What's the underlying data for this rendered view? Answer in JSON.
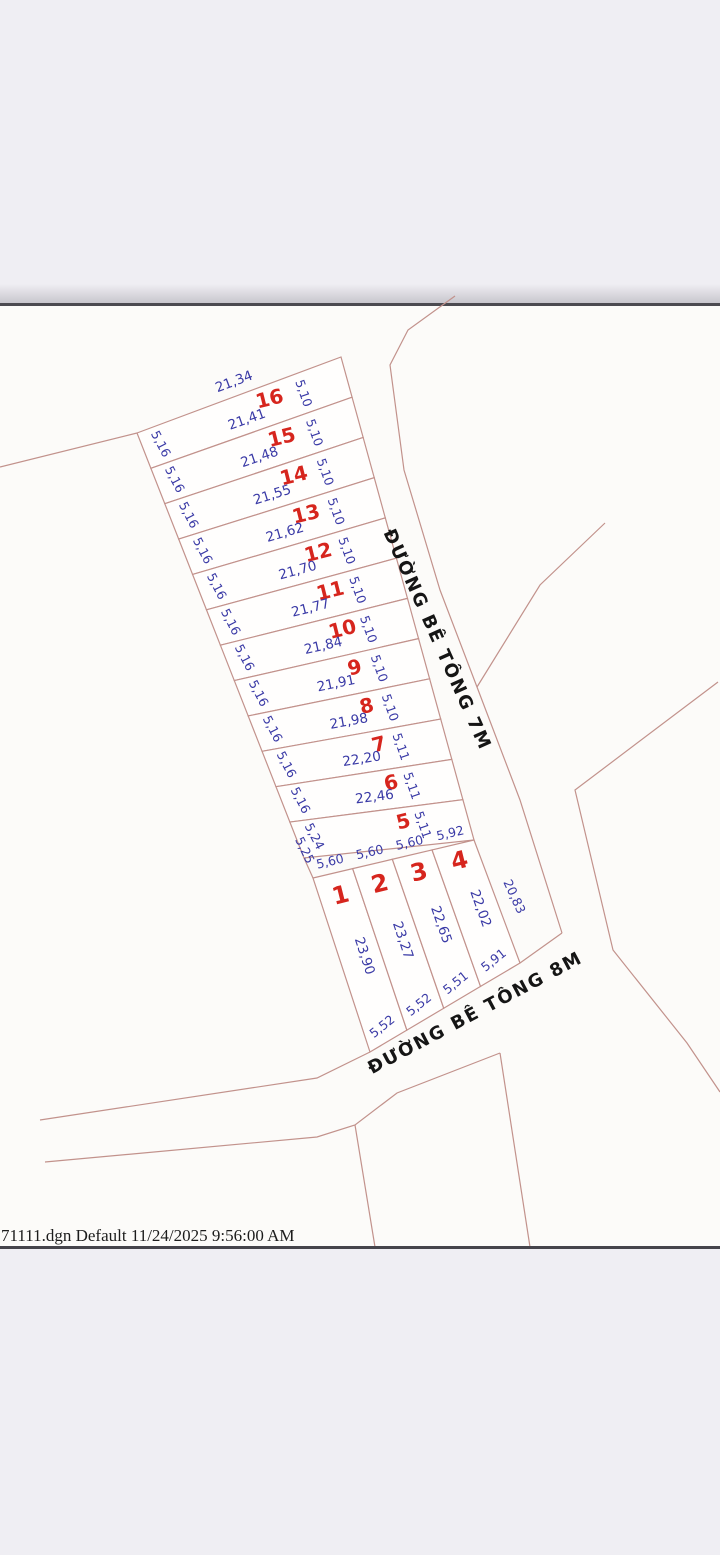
{
  "page": {
    "file_info": "71111.dgn Default 11/24/2025 9:56:00 AM"
  },
  "roads": {
    "road7m_label": "ĐƯỜNG BÊ TÔNG 7M",
    "road8m_label": "ĐƯỜNG BÊ TÔNG 8M"
  },
  "colors": {
    "boundary_line": "#c2928c",
    "dimension_text": "#3a3aa6",
    "plot_number": "#d6251d",
    "road_text": "#151515"
  },
  "strip_plots": [
    {
      "number": "16",
      "length": "21,34",
      "left_width": "5,16",
      "right_width": "5,10"
    },
    {
      "number": "15",
      "length": "21,41",
      "left_width": "5,16",
      "right_width": "5,10"
    },
    {
      "number": "14",
      "length": "21,48",
      "left_width": "5,16",
      "right_width": "5,10"
    },
    {
      "number": "13",
      "length": "21,55",
      "left_width": "5,16",
      "right_width": "5,10"
    },
    {
      "number": "12",
      "length": "21,62",
      "left_width": "5,16",
      "right_width": "5,10"
    },
    {
      "number": "11",
      "length": "21,70",
      "left_width": "5,16",
      "right_width": "5,10"
    },
    {
      "number": "10",
      "length": "21,77",
      "left_width": "5,16",
      "right_width": "5,10"
    },
    {
      "number": "9",
      "length": "21,84",
      "left_width": "5,16",
      "right_width": "5,10"
    },
    {
      "number": "8",
      "length": "21,91",
      "left_width": "5,16",
      "right_width": "5,10"
    },
    {
      "number": "7",
      "length": "21,98",
      "left_width": "5,16",
      "right_width": "5,11"
    },
    {
      "number": "6",
      "length": "22,20",
      "left_width": "5,16",
      "right_width": "5,11"
    },
    {
      "number": "5",
      "length": "22,46",
      "left_width": "5,24",
      "right_width": "5,11"
    }
  ],
  "bottom_plots": [
    {
      "number": "1",
      "top_width": "5,60",
      "side_length": "23,90",
      "bottom_width": "5,52"
    },
    {
      "number": "2",
      "top_width": "5,60",
      "side_length": "23,27",
      "bottom_width": "5,52"
    },
    {
      "number": "3",
      "top_width": "5,60",
      "side_length": "22,65",
      "bottom_width": "5,51"
    },
    {
      "number": "4",
      "top_width": "5,92",
      "side_length": "22,02",
      "bottom_width": "5,91",
      "right_side_length": "20,83"
    }
  ],
  "extra_dimensions": [
    {
      "label": "5,25"
    }
  ]
}
